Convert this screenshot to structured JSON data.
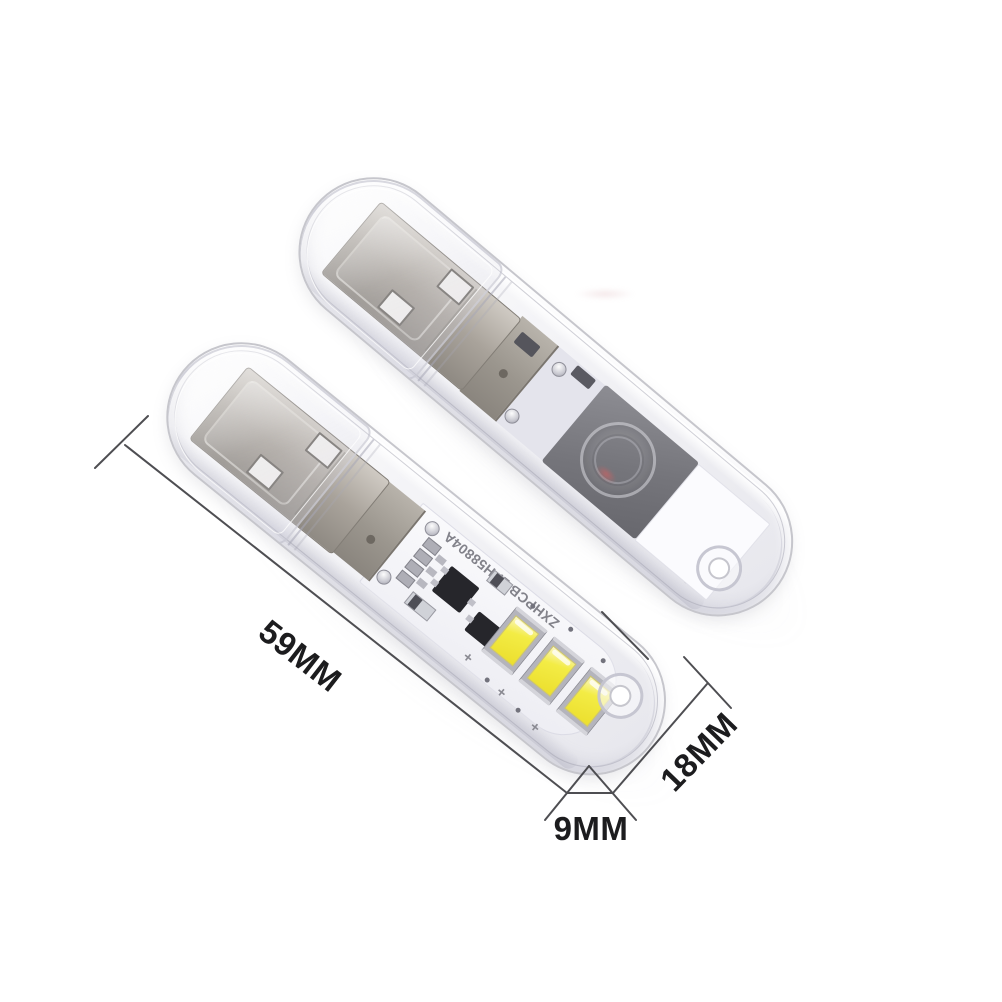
{
  "annotations": {
    "length": "59MM",
    "width": "18MM",
    "thickness": "9MM"
  },
  "device_front": {
    "pcb_silkscreen": "ZXHPCB 2PH58804A",
    "polarity_mark": "+",
    "led_count": 3
  },
  "colors": {
    "dimension_lines": "#4e4e52",
    "annotation_text": "#1c1c1e",
    "led_yellow": "#f0e93c",
    "usb_metal": "#a8a29a",
    "shell_outline": "#c6c6cc",
    "pcb_white": "#f7f7fa",
    "dark_plate": "#77777d",
    "indicator_red": "#e05858"
  }
}
